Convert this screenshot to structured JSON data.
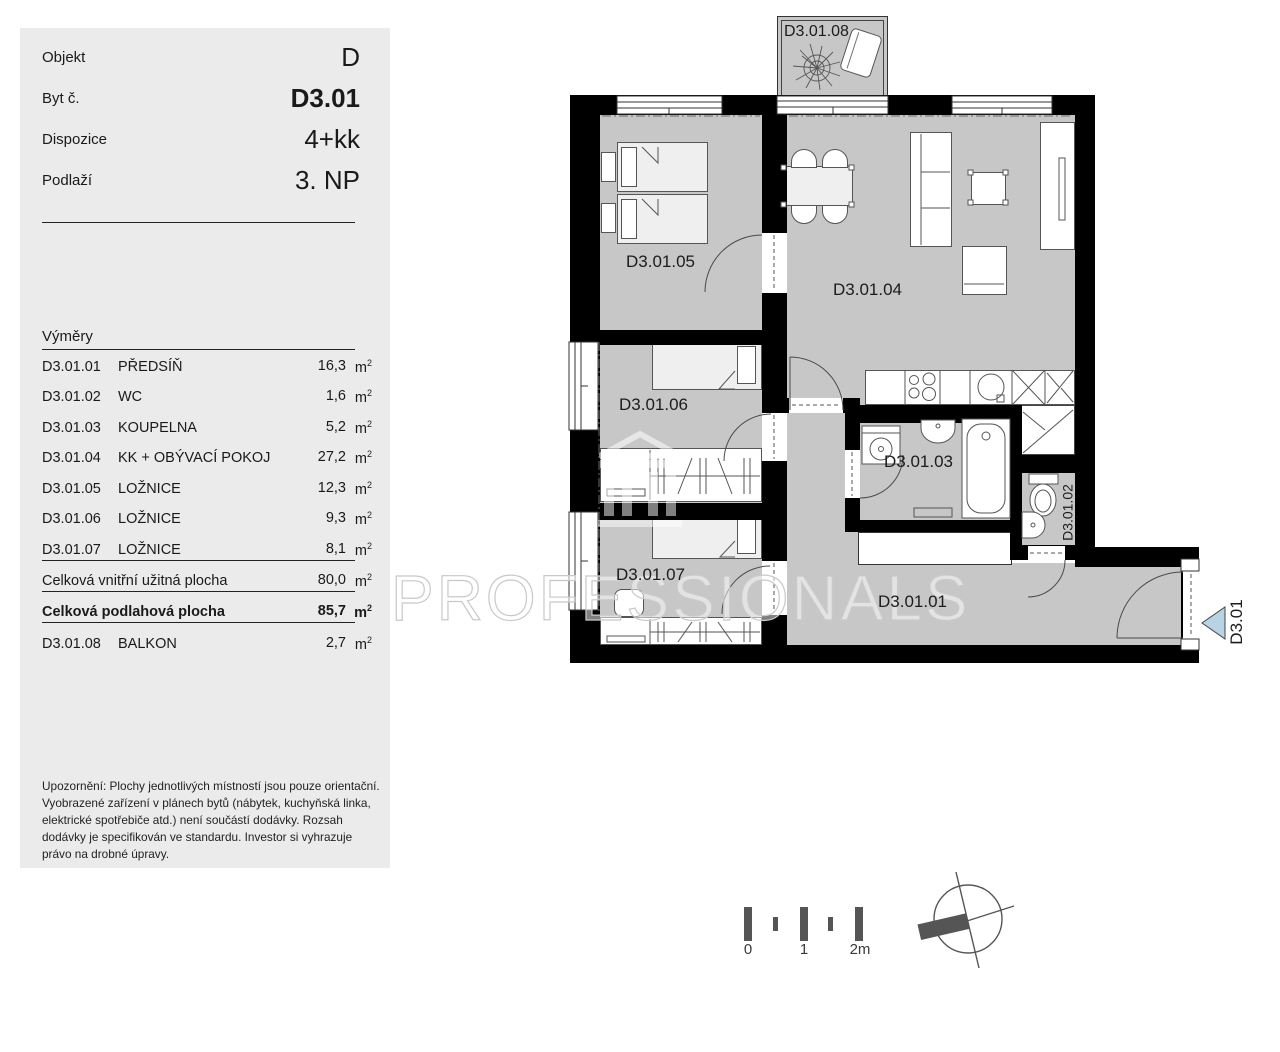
{
  "sidebar": {
    "header": {
      "rows": [
        {
          "label": "Objekt",
          "value": "D"
        },
        {
          "label": "Byt č.",
          "value": "D3.01"
        },
        {
          "label": "Dispozice",
          "value": "4+kk"
        },
        {
          "label": "Podlaží",
          "value": "3. NP"
        }
      ]
    },
    "areas": {
      "title": "Výměry",
      "unit_base": "m",
      "unit_sup": "2",
      "rows": [
        {
          "code": "D3.01.01",
          "name": "PŘEDSÍŇ",
          "value": "16,3"
        },
        {
          "code": "D3.01.02",
          "name": "WC",
          "value": "1,6"
        },
        {
          "code": "D3.01.03",
          "name": "KOUPELNA",
          "value": "5,2"
        },
        {
          "code": "D3.01.04",
          "name": "KK + OBÝVACÍ POKOJ",
          "value": "27,2"
        },
        {
          "code": "D3.01.05",
          "name": "LOŽNICE",
          "value": "12,3"
        },
        {
          "code": "D3.01.06",
          "name": "LOŽNICE",
          "value": "9,3"
        },
        {
          "code": "D3.01.07",
          "name": "LOŽNICE",
          "value": "8,1"
        }
      ],
      "totals": [
        {
          "label": "Celková vnitřní užitná plocha",
          "value": "80,0"
        },
        {
          "label": "Celková podlahová plocha",
          "value": "85,7"
        }
      ],
      "balcony": {
        "code": "D3.01.08",
        "name": "BALKON",
        "value": "2,7"
      }
    },
    "disclaimer": "Upozornění: Plochy jednotlivých místností jsou pouze orientační. Vyobrazené zařízení v plánech bytů (nábytek, kuchyňská linka, elektrické spotřebiče atd.) není součástí dodávky. Rozsah dodávky je specifikován ve standardu. Investor si vyhrazuje právo na drobné úpravy."
  },
  "plan": {
    "rooms": {
      "hall": "D3.01.01",
      "wc": "D3.01.02",
      "bathroom": "D3.01.03",
      "living": "D3.01.04",
      "bedroom1": "D3.01.05",
      "bedroom2": "D3.01.06",
      "bedroom3": "D3.01.07",
      "balcony": "D3.01.08"
    },
    "entrance_label": "D3.01",
    "watermark": "PROFESSIONALS",
    "scale_labels": [
      "0",
      "1",
      "2m"
    ],
    "colors": {
      "room_fill": "#c7c7c7",
      "wall": "#000000",
      "panel": "#ebebeb",
      "entrance_marker": "#b7d3e4"
    }
  }
}
